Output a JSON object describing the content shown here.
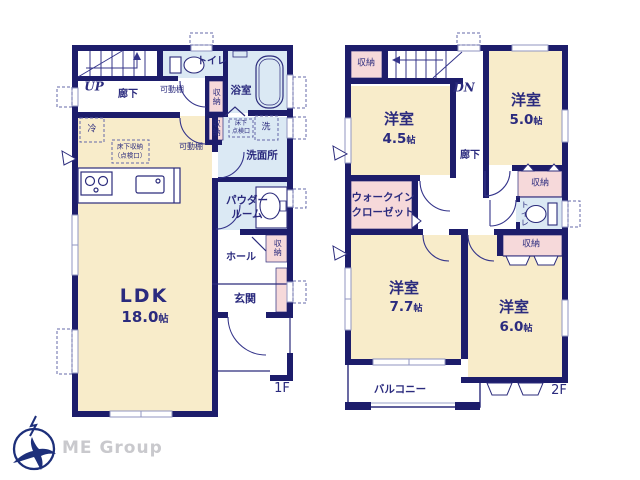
{
  "brand": {
    "name": "ME Group"
  },
  "colors": {
    "wall": "#1d1d6b",
    "room": "#f8ecca",
    "wet": "#dbe9f4",
    "storage": "#f6d9da",
    "text": "#2b2b7e"
  },
  "floor1": {
    "label": "1F",
    "rooms": {
      "stairs": "UP",
      "corridor": "廊下",
      "toilet": "トイレ",
      "bath": "浴室",
      "washroom": "洗面所",
      "powder_line1": "パウダー",
      "powder_line2": "ルーム",
      "hall": "ホール",
      "entrance": "玄関",
      "ldk": {
        "name": "LDK",
        "size_num": "18.0",
        "size_unit": "帖"
      },
      "storage_a": "収納",
      "storage_b": "収納",
      "storage_hall": "収納",
      "shelf_a": "可動棚",
      "shelf_b": "可動棚",
      "fridge": "冷",
      "underfloor_line1": "床下収納",
      "underfloor_line2": "（点検口）",
      "inspection_line1": "床下",
      "inspection_line2": "点検口",
      "washer": "洗"
    }
  },
  "floor2": {
    "label": "2F",
    "rooms": {
      "stairs": "DN",
      "corridor": "廊下",
      "storage_top": "収納",
      "room_a": {
        "name": "洋室",
        "size_num": "4.5",
        "size_unit": "帖"
      },
      "room_b": {
        "name": "洋室",
        "size_num": "5.0",
        "size_unit": "帖"
      },
      "room_c": {
        "name": "洋室",
        "size_num": "7.7",
        "size_unit": "帖"
      },
      "room_d": {
        "name": "洋室",
        "size_num": "6.0",
        "size_unit": "帖"
      },
      "wic_line1": "ウォークイン",
      "wic_line2": "クローゼット",
      "storage_r1": "収納",
      "storage_r2": "収納",
      "toilet": "トイレ",
      "balcony": "バルコニー"
    }
  }
}
